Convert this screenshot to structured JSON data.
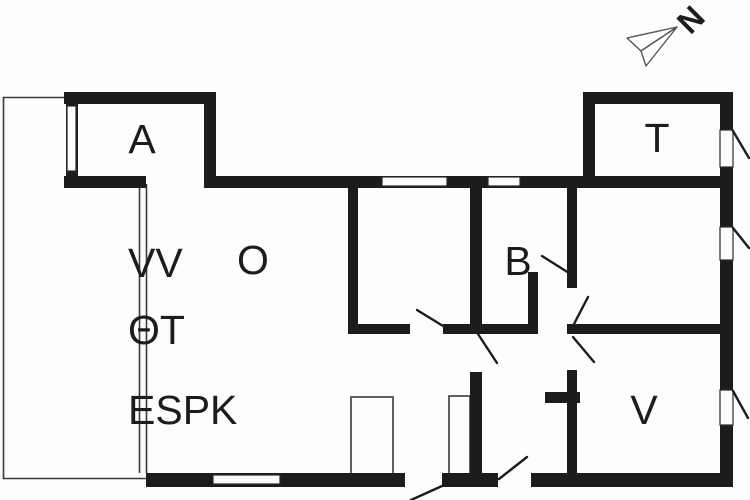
{
  "plan": {
    "type": "floor-plan",
    "rooms": [
      {
        "id": "room-a",
        "label": "A"
      },
      {
        "id": "room-t",
        "label": "T"
      },
      {
        "id": "room-o",
        "label": "O"
      },
      {
        "id": "room-b",
        "label": "B"
      },
      {
        "id": "room-v",
        "label": "V"
      }
    ],
    "annotations": [
      {
        "id": "fixture-vv",
        "label": "VV"
      },
      {
        "id": "fixture-ot",
        "label": "ΘT"
      },
      {
        "id": "fixture-espk",
        "label": "ESPK"
      }
    ],
    "north_label": "N",
    "colors": {
      "wall": "#1c1c1c",
      "line": "#3a3a3a",
      "frame": "#2a2a2a",
      "background": "#fdfdfb",
      "arrow_outline": "#555555"
    }
  }
}
